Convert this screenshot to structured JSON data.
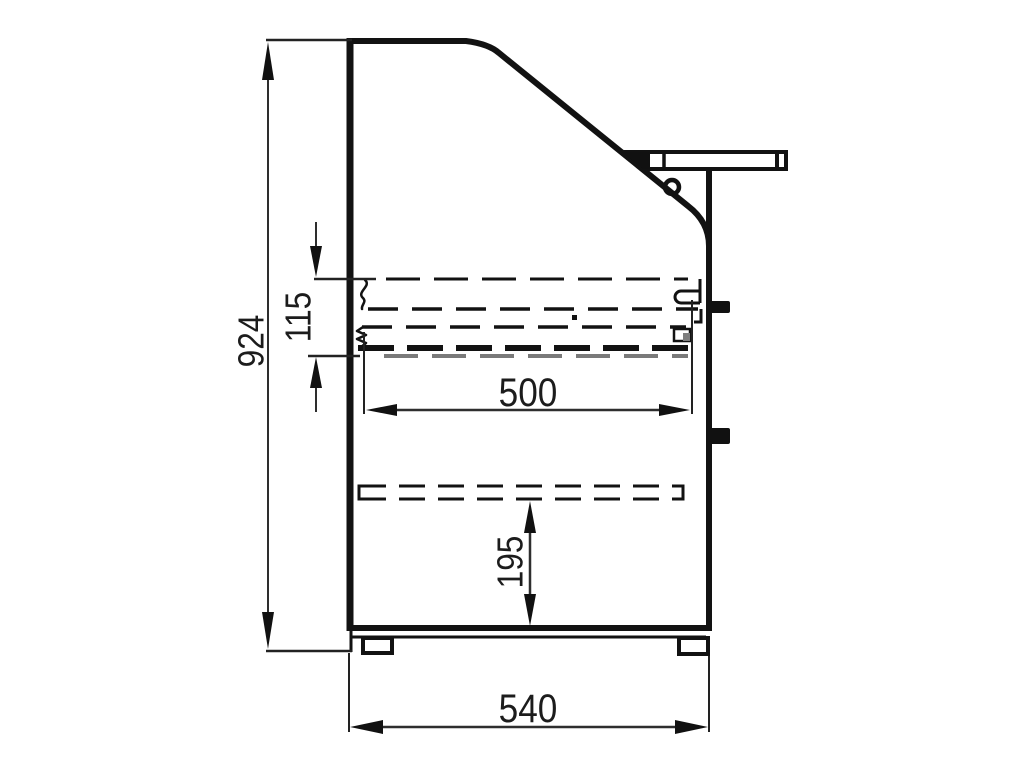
{
  "drawing": {
    "dimensions": {
      "overall_height": "924",
      "rail_gap_height": "115",
      "rail_length": "500",
      "lower_shelf_height": "195",
      "base_width": "540"
    },
    "colors": {
      "object_line": "#121212",
      "dimension_line": "#2e2e2e",
      "gray_rail": "#7a7a7a",
      "background": "#ffffff"
    }
  }
}
